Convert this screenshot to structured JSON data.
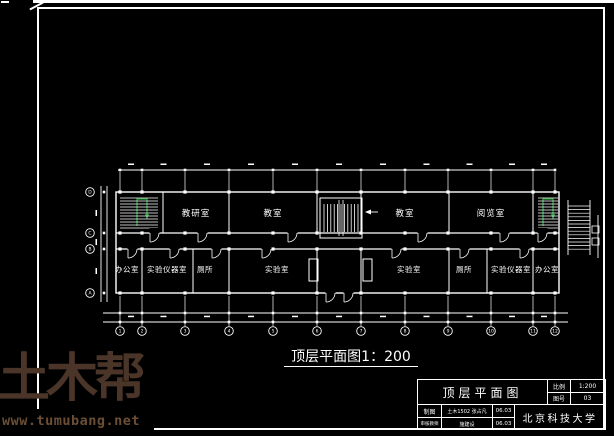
{
  "page": {
    "background": "#000000",
    "frame_color": "#ffffff"
  },
  "watermark": {
    "logo_text": "土木帮",
    "site_url": "www.tumubang.net",
    "logo_color": "#4a3528",
    "url_color": "#6a4e36"
  },
  "plan": {
    "caption": "顶层平面图1：200",
    "line_color": "#ffffff",
    "stair_color": "#1aa534",
    "rooms": {
      "top_1": "教研室",
      "top_2": "教室",
      "top_3": "教室",
      "top_4": "阅览室",
      "bottom_1": "办公室",
      "bottom_2": "实验仪器室",
      "bottom_3": "厕所",
      "bottom_4": "实验室",
      "bottom_5": "实验室",
      "bottom_6": "厕所",
      "bottom_7": "实验仪器室",
      "bottom_8": "办公室"
    },
    "grid": {
      "columns": [
        "1",
        "2",
        "3",
        "4",
        "5",
        "6",
        "7",
        "8",
        "9",
        "10",
        "11",
        "12"
      ],
      "rows": [
        "A",
        "B",
        "C",
        "D"
      ]
    }
  },
  "title_block": {
    "drawing_title": "顶层平面图",
    "scale_label": "比例",
    "scale_value": "1:200",
    "sheet_no_label": "图号",
    "sheet_no_value": "03",
    "drafter_label": "制图",
    "drafter_value": "土木1502 张占凡",
    "drafter_date": "06.03",
    "checker_label": "审核教师",
    "checker_value": "施建设",
    "checker_date": "06.03",
    "organization": "北京科技大学"
  }
}
